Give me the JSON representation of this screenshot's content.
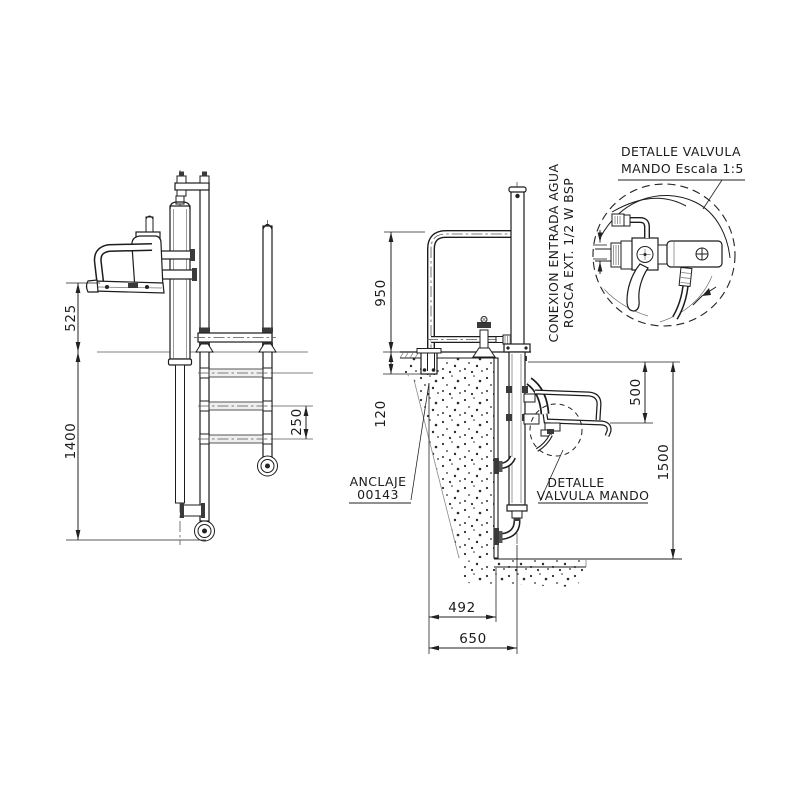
{
  "document": {
    "type": "technical-drawing",
    "background": "#ffffff",
    "line_color": "#1c1c1c",
    "secondary_line_color": "#9a9a9a"
  },
  "detail_view": {
    "title_line1": "DETALLE VALVULA",
    "title_line2": "MANDO Escala 1:5"
  },
  "callouts": {
    "water_inlet_line1": "CONEXION ENTRADA AGUA",
    "water_inlet_line2": "ROSCA EXT. 1/2 W BSP",
    "anchor_line1": "ANCLAJE",
    "anchor_line2": "00143",
    "valve_ref_line1": "DETALLE",
    "valve_ref_line2": "VALVULA MANDO"
  },
  "dimensions": {
    "front_seat_height": "525",
    "front_submerged_depth": "1400",
    "front_rung_spacing": "250",
    "side_rail_height": "950",
    "side_anchor_depth": "120",
    "side_seat_drop": "500",
    "side_total_depth": "1500",
    "side_wall_offset": "492",
    "side_axis_offset": "650"
  }
}
